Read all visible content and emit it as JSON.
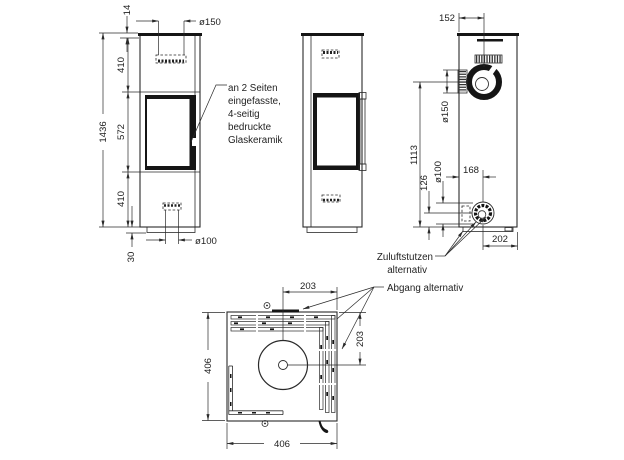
{
  "drawing_title": "Kaminofen Masszeichnung",
  "colors": {
    "line": "#2a2a2a",
    "dark": "#151515",
    "background": "#ffffff"
  },
  "front_view": {
    "dim_top_plate": "14",
    "dim_flue_top": "ø150",
    "dim_upper": "410",
    "dim_total_height": "1436",
    "dim_window": "572",
    "dim_lower": "410",
    "dim_base": "30",
    "dim_air_bottom": "ø100"
  },
  "back_view": {
    "dim_flue_offset": "152",
    "dim_flue_dia": "ø150",
    "dim_flue_height": "1113",
    "dim_air_height": "126",
    "dim_air_dia": "ø100",
    "dim_air_offset": "168",
    "dim_air_side": "202"
  },
  "top_view": {
    "dim_half_width": "203",
    "dim_half_depth": "203",
    "dim_depth": "406",
    "dim_width": "406"
  },
  "notes": {
    "glass_line1": "an 2 Seiten",
    "glass_line2": "eingefasste,",
    "glass_line3": "4-seitig",
    "glass_line4": "bedruckte",
    "glass_line5": "Glaskeramik",
    "air_line1": "Zuluftstutzen",
    "air_line2": "alternativ",
    "flue_alt": "Abgang alternativ"
  }
}
